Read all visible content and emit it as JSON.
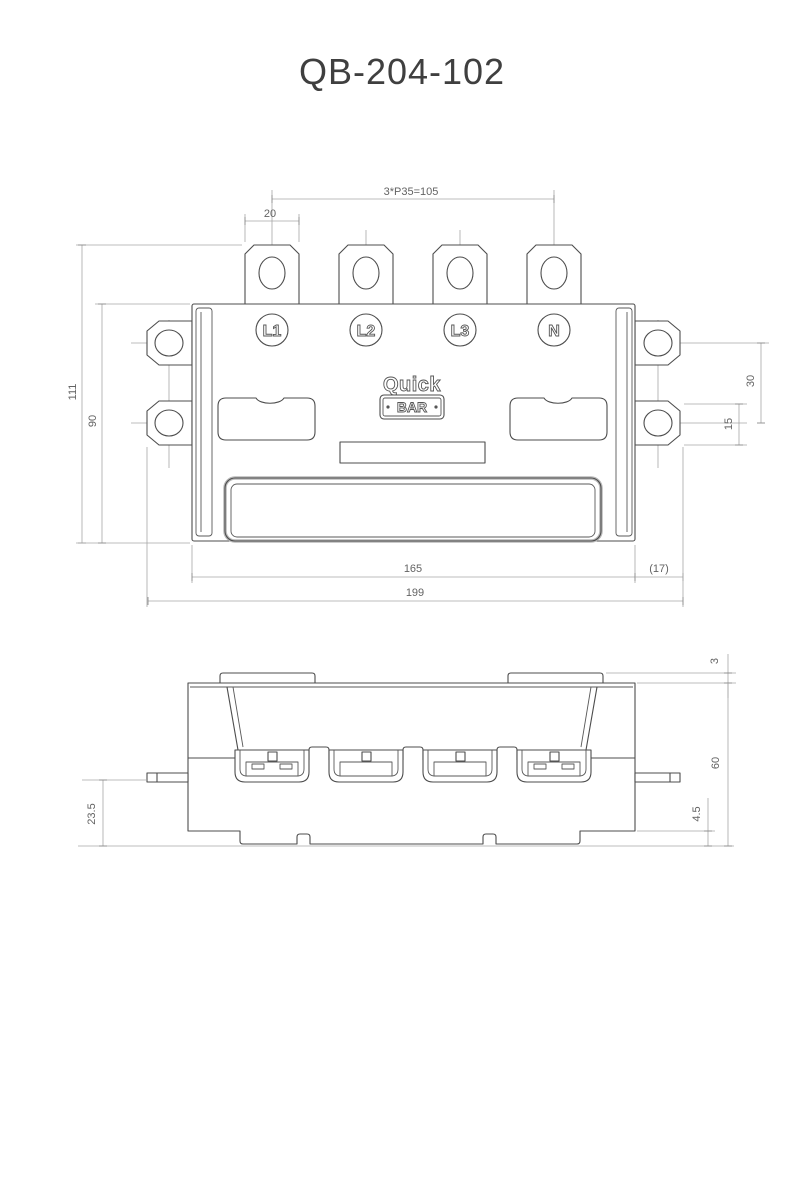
{
  "title": "QB-204-102",
  "drawing": {
    "brand": {
      "name_top": "Quick",
      "name_bottom": "BAR"
    },
    "terminals": {
      "t1": "L1",
      "t2": "L2",
      "t3": "L3",
      "t4": "N"
    },
    "dims": {
      "pitch": "3*P35=105",
      "lug_width": "20",
      "total_height": "111",
      "body_height": "90",
      "mount_hole_spacing": "30",
      "mount_hole_offset": "15",
      "body_width": "165",
      "flange_ext": "(17)",
      "total_width": "199",
      "cover_lip": "3",
      "side_height": "60",
      "base_step": "4.5",
      "pin_height": "23.5"
    },
    "colors": {
      "line": "#4d4d4d",
      "dim": "#a6a6a6",
      "text": "#636363"
    }
  }
}
